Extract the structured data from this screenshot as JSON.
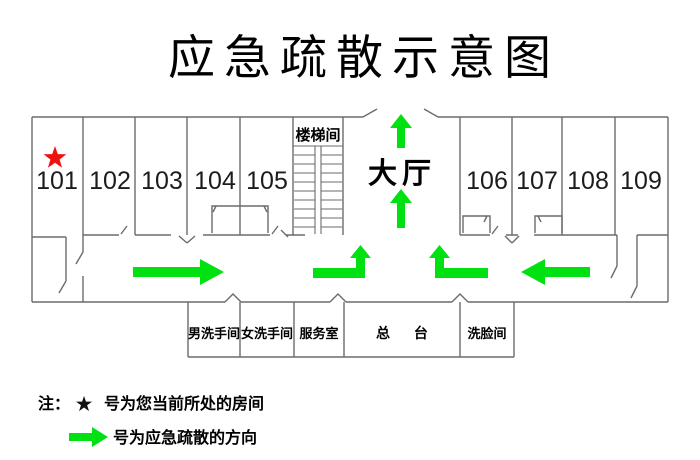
{
  "title": "应急疏散示意图",
  "floor_plan": {
    "rooms_top": [
      "101",
      "102",
      "103",
      "104",
      "105"
    ],
    "rooms_right": [
      "106",
      "107",
      "108",
      "109"
    ],
    "stairwell": "楼梯间",
    "lobby": "大厅",
    "rooms_bottom": [
      "男洗手间",
      "女洗手间",
      "服务室",
      "总 台",
      "洗脸间"
    ]
  },
  "legend": {
    "note_prefix": "注：",
    "star_symbol": "★",
    "current_room_text": "号为您当前所处的房间",
    "evacuation_text": "号为应急疏散的方向"
  },
  "colors": {
    "arrow": "#00e112",
    "star": "#ee1111",
    "wall": "#6b6b6b"
  }
}
